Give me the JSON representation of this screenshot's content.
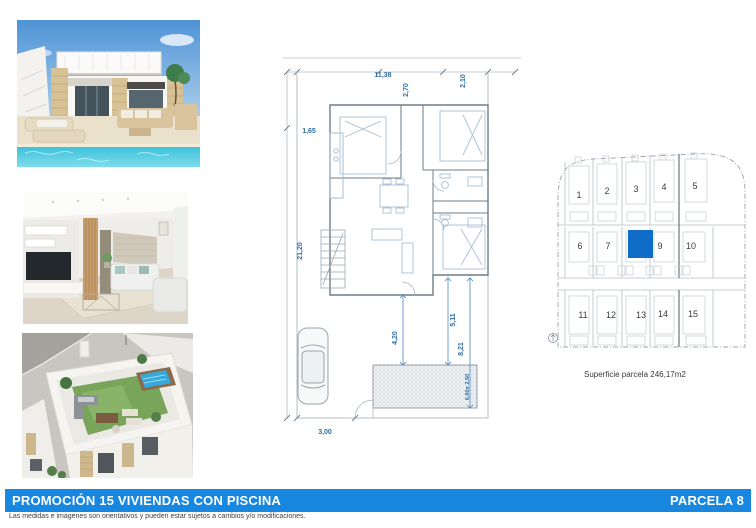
{
  "banner": {
    "title": "PROMOCIÓN 15 VIVIENDAS CON PISCINA",
    "parcel_label": "PARCELA 8",
    "color": "#1787e0"
  },
  "disclaimer": "Las medidas e imagenes son orientativos y pueden estar sujetos a cambios y/o modificaciones.",
  "floorplan": {
    "dimensions": {
      "width_top": "11,38",
      "porch_depth": "2,70",
      "entry_width": "2,10",
      "side_setback": "1,65",
      "height_left": "21,20",
      "garden_depth": "4,20",
      "pool_offset": "5,11",
      "garden_height": "8,21",
      "pool_size": "6,00x 2,50",
      "drive_width": "3,00"
    }
  },
  "sitemap": {
    "plots": [
      "1",
      "2",
      "3",
      "4",
      "5",
      "6",
      "7",
      "8",
      "9",
      "10",
      "11",
      "12",
      "13",
      "14",
      "15"
    ],
    "highlighted_plot": "8",
    "highlight_color": "#0f6cc9",
    "caption": "Superficie parcela 246,17m2"
  },
  "photos": {
    "labels": [
      "villa-exterior-pool-render",
      "living-room-interior-render",
      "rooftop-terrace-aerial-render"
    ]
  }
}
